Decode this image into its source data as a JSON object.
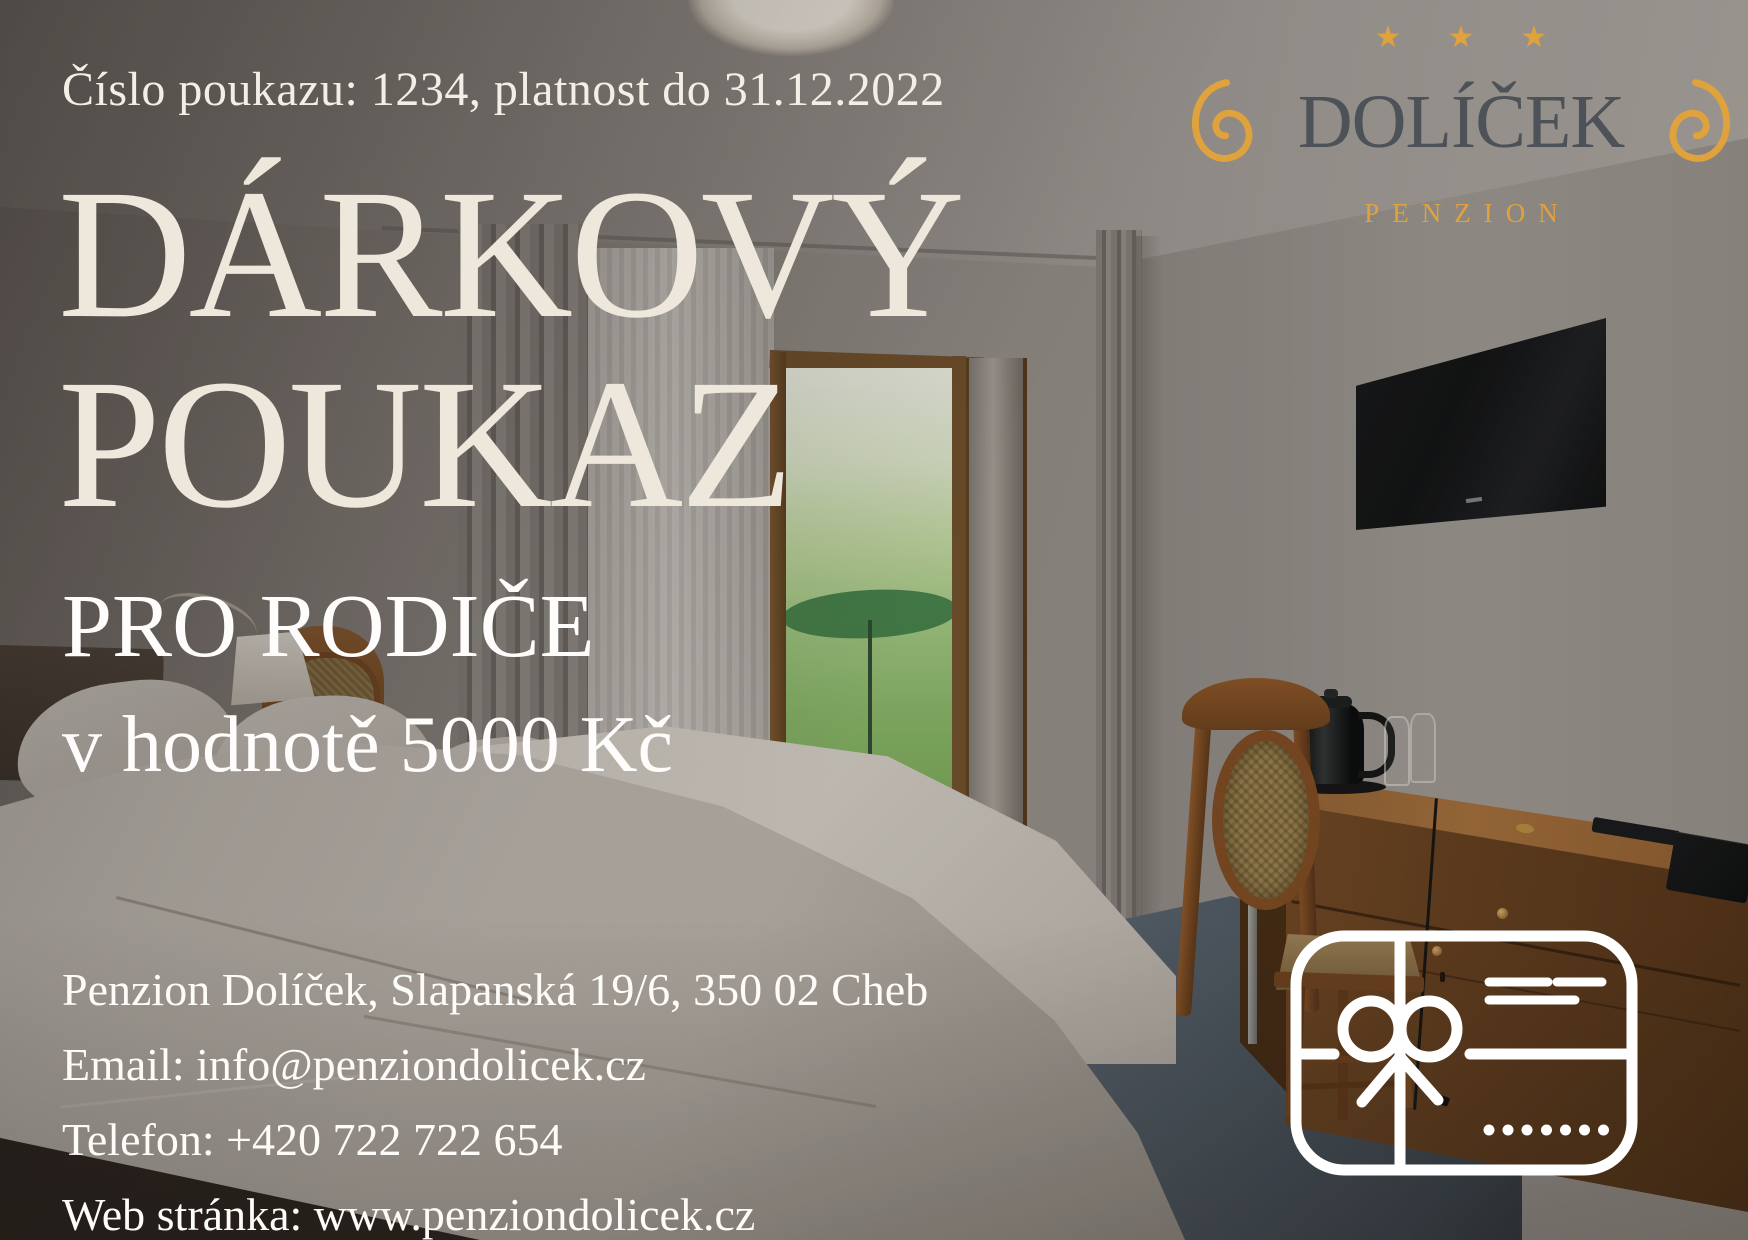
{
  "voucher": {
    "number_line": "Číslo poukazu: 1234, platnost do 31.12.2022",
    "title_line1": "DÁRKOVÝ",
    "title_line2": "POUKAZ",
    "subtitle": "PRO RODIČE",
    "value_line": "v hodnotě 5000 Kč",
    "contact": {
      "address": "Penzion Dolíček, Slapanská 19/6, 350 02 Cheb",
      "email": "Email: info@penziondolicek.cz",
      "phone": "Telefon: +420 722 722 654",
      "web": "Web stránka: www.penziondolicek.cz"
    }
  },
  "logo": {
    "wordmark": "DOLÍČEK",
    "tagline": "PENZION",
    "star": "★",
    "star_count": 3
  },
  "icons": {
    "gift_card": "gift-card-outline-icon",
    "swirl_left": "swirl-ornament-icon",
    "swirl_right": "swirl-ornament-icon",
    "star": "star-icon"
  },
  "colors": {
    "gold": "#DFA23C",
    "brand_text": "#4C5258",
    "title_cream": "#EDE8DB",
    "body_white": "#FDFCF9",
    "icon_white": "#FFFFFF"
  },
  "background": {
    "type": "photo",
    "subject": "hotel room with bed, window to garden, wall TV, wooden desk and chair"
  }
}
